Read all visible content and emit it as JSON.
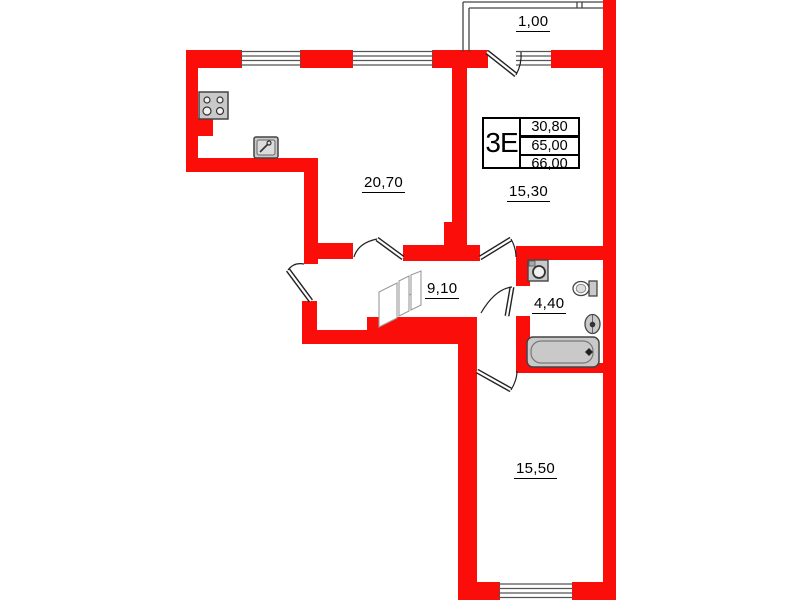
{
  "summary": {
    "flat_type": "3Е",
    "rows": [
      "30,80",
      "65,00",
      "66,00"
    ]
  },
  "rooms": {
    "balcony": "1,00",
    "kitchen_living": "20,70",
    "room1": "15,30",
    "hallway": "9,10",
    "bathroom": "4,40",
    "room2": "15,50"
  },
  "icons": {
    "stove": "stove-icon",
    "kitchen_sink": "sink-icon",
    "washing_machine": "washing-machine-icon",
    "toilet": "toilet-icon",
    "washbasin": "washbasin-icon",
    "bathtub": "bathtub-icon",
    "wardrobe": "wardrobe-icon"
  },
  "colors": {
    "wall": "#fb0e0a",
    "fixture_fill": "#c9c9c9",
    "line": "#2a2a2a"
  }
}
